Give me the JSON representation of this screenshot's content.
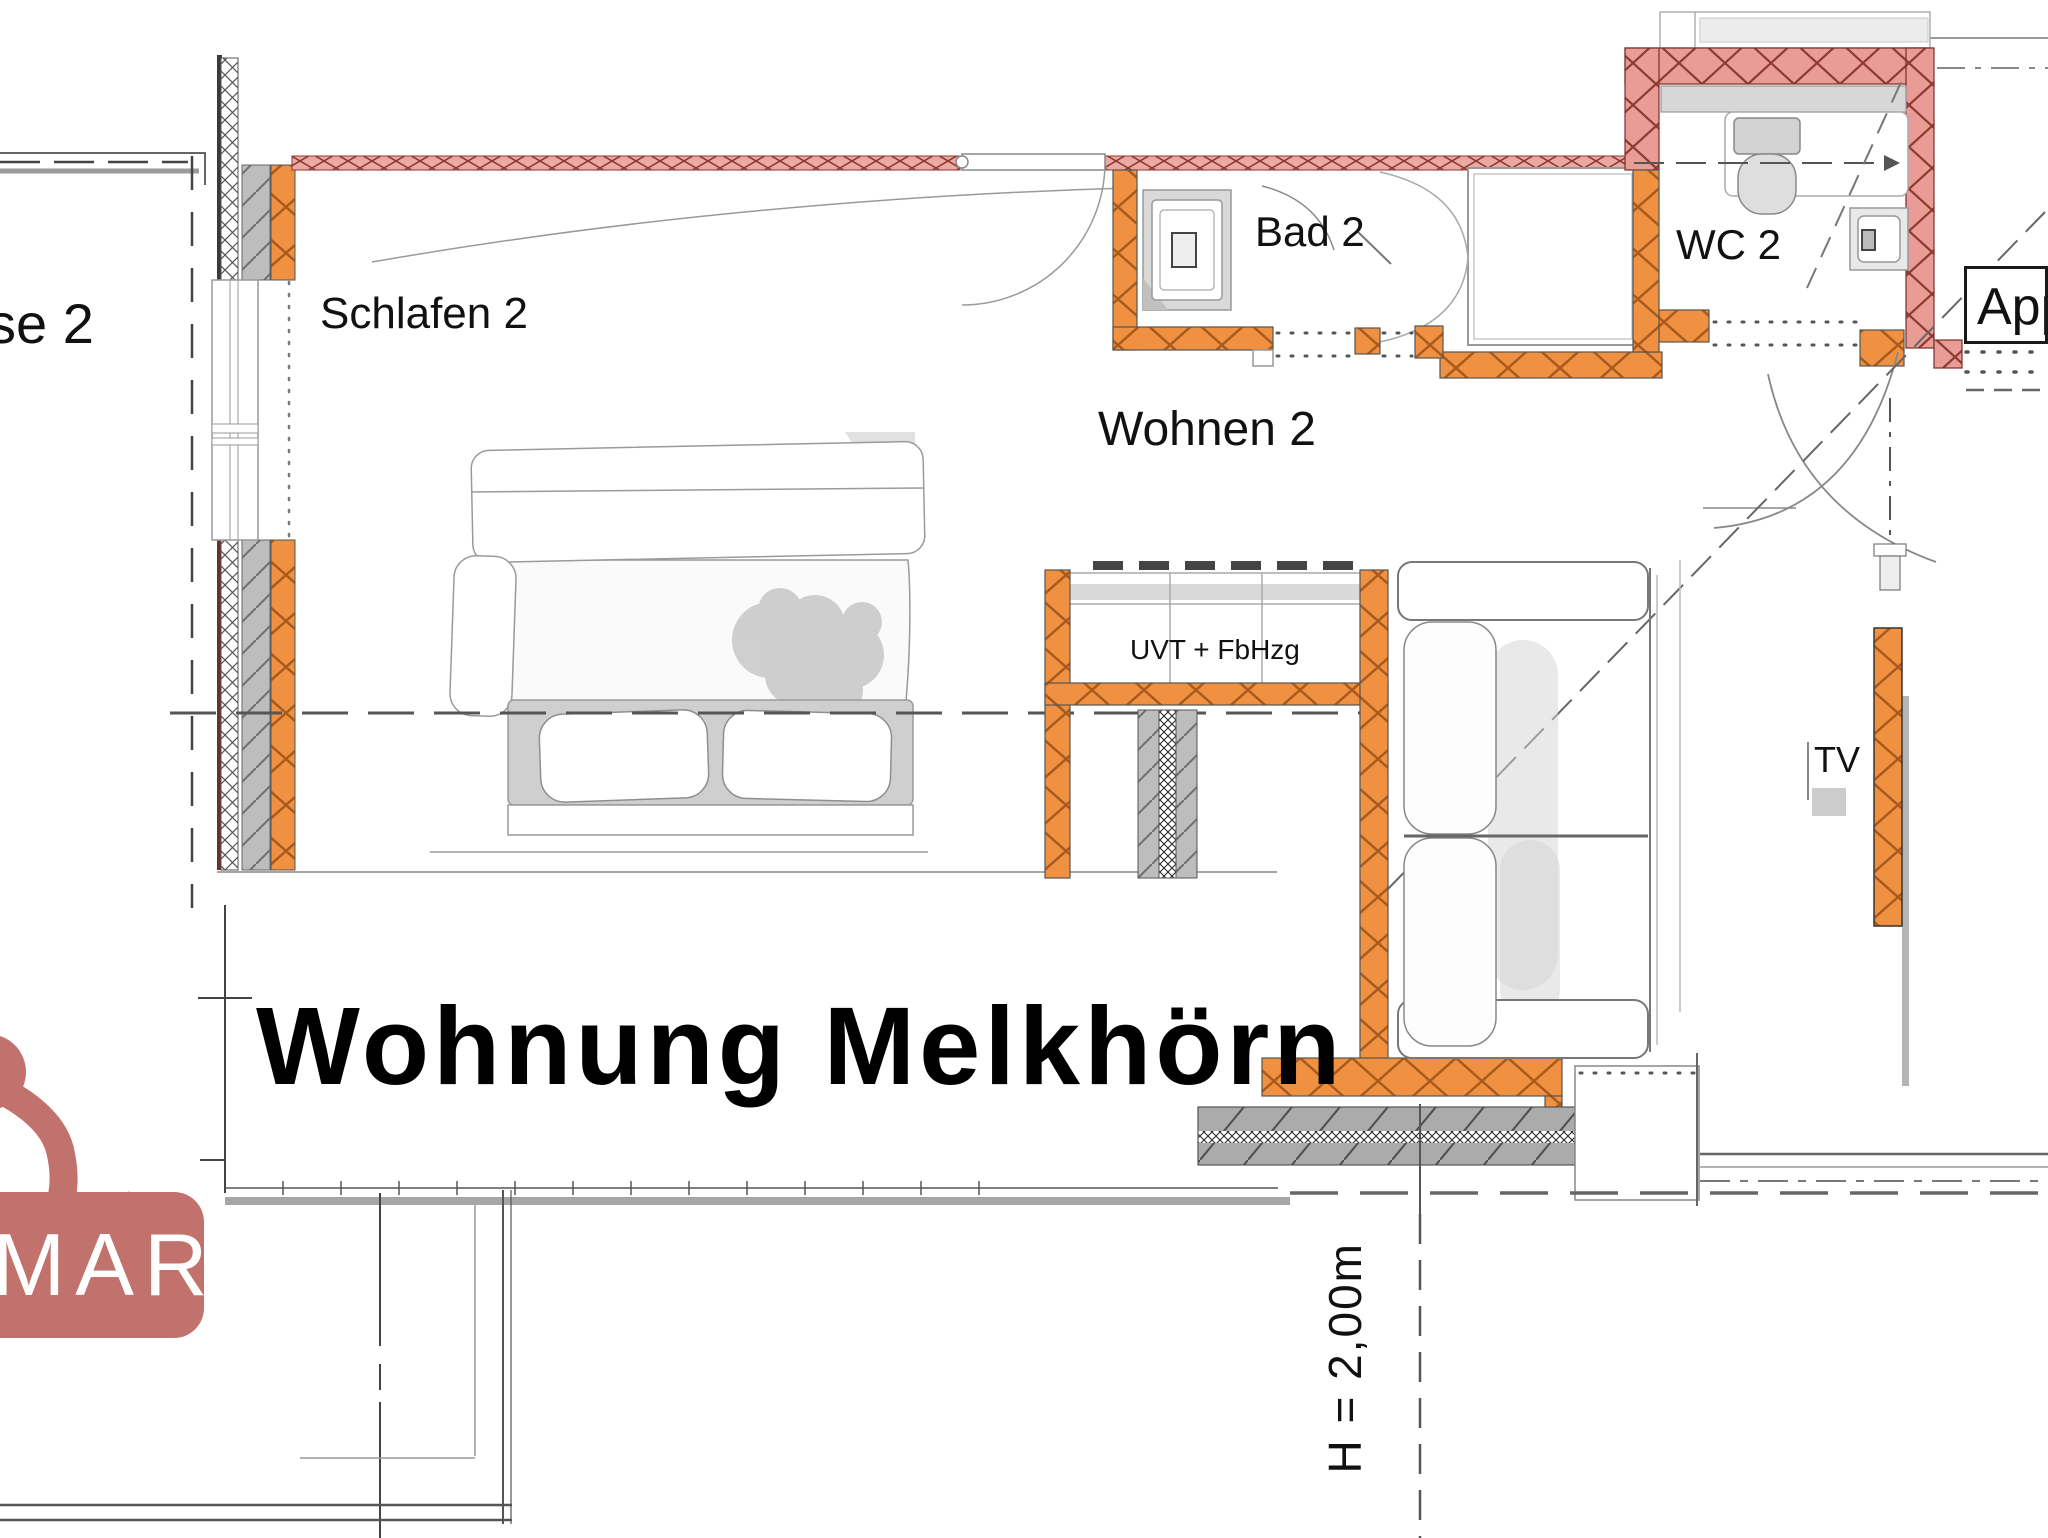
{
  "title": "Wohnung Melkhörn",
  "labels": {
    "terrasse_partial": "sse 2",
    "schlafen": "Schlafen 2",
    "wohnen": "Wohnen 2",
    "bad": "Bad 2",
    "wc": "WC 2",
    "appartement_partial": "App",
    "uvt": "UVT + FbHzg",
    "tv": "TV",
    "height_dim": "H = 2,00m"
  },
  "logo": {
    "text_partial": "MAR",
    "color": "#c2726c"
  },
  "colors": {
    "wall_orange": "#ef9140",
    "wall_orange_hatch": "#a85a1e",
    "wall_pink": "#e99b95",
    "wall_pink_hatch": "#8d3a33",
    "wall_gray": "#bdbdbd",
    "floor_gray": "#ababab",
    "fixture_gray": "#d9d9d9",
    "sketch_gray": "#b0b0b0",
    "line_dark": "#444444",
    "text": "#111111"
  }
}
